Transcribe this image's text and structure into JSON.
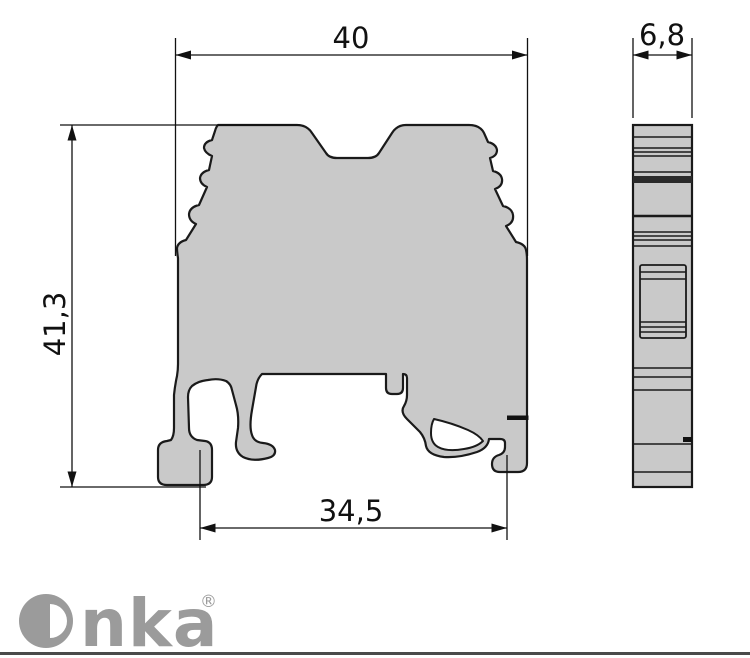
{
  "drawing": {
    "type": "technical dimension drawing",
    "product": "DIN rail screw terminal block",
    "views": {
      "front_view": "terminal block profile with serrated clamp sides and DIN rail foot",
      "side_view": "narrow side elevation with horizontal part lines"
    },
    "dimensions": {
      "width_top": "40",
      "height_left": "41,3",
      "width_bottom": "34,5",
      "thickness_side": "6,8"
    },
    "colors": {
      "body_fill": "#c9c9c9",
      "outline": "#1a1a1a",
      "dimension_lines": "#111111",
      "logo_gray": "#9b9b9b",
      "footer_bar": "#4a4a4a",
      "background": "#ffffff"
    }
  },
  "branding": {
    "logo_text": "Onka",
    "logo_text_partial": "nka",
    "registered_mark": "®"
  }
}
